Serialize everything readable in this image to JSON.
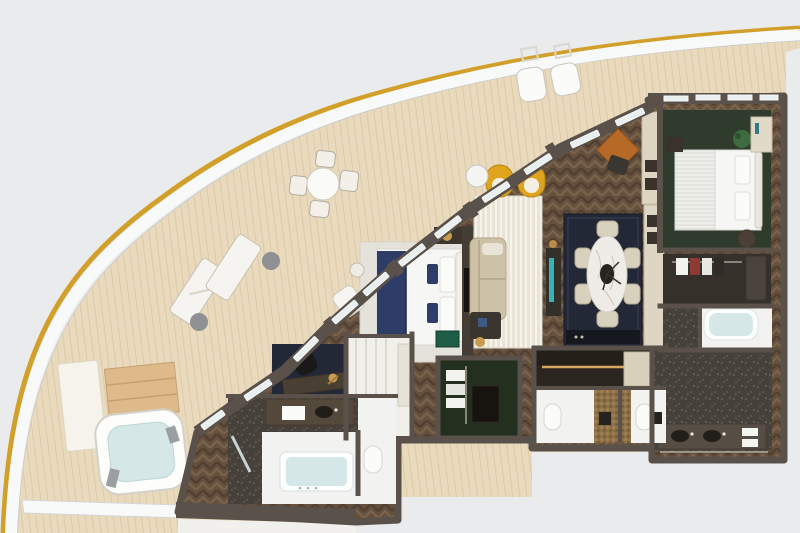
{
  "scene": {
    "type": "floorplan-3d-render",
    "subject": "cruise-ship suite, top-down view",
    "orientation": "curved hull with wrap-around balcony at top-left, interior rooms at right",
    "visible_text": "none"
  },
  "colors": {
    "bg": "#e9ebec",
    "gold": "#d2a02a",
    "hullWhite": "#f8f9f9",
    "hullShadow": "#c7c9ca",
    "deck": "#e9d9bd",
    "deckLine": "#cdb astonish",
    "deckLine2": "#cfb astonish",
    "deckStripe": "#d2bd99",
    "wood": "#65503e",
    "woodLight": "#7d664f",
    "woodDark": "#4c3b2f",
    "wall": "#59514a",
    "wallDark": "#433d36",
    "glass": "#e9eeee",
    "frame": "#f6f8f8",
    "rugLiving": "#e9e4d5",
    "rugStripe": "#f7f4ec",
    "rugBed": "#e5e2db",
    "bedWhite": "#f6f6f4",
    "navy": "#2e3c68",
    "navyDark": "#20294a",
    "yellow": "#dfa41e",
    "sofa": "#cdc1a8",
    "rugDining": "#232836",
    "marble": "#efece7",
    "chairCream": "#d8d1bd",
    "greenBedroom": "#2f3b2d",
    "greenCloset": "#24301f",
    "terrazzo": "#46413a",
    "terrazzoDot": "#6d675e",
    "whiteFloor": "#f2f3f1",
    "goldWall": "#8d7046",
    "water": "#d5e7e6",
    "woodSteps": "#deba8b",
    "cognac": "#b66a28",
    "teal": "#35c2c4",
    "malachite": "#1f5c45",
    "lampGold": "#c89b4e",
    "black": "#1d1b18",
    "pouf": "#4a4036",
    "plant": "#3f6b41",
    "clothesRed": "#8d3a35",
    "counterDark": "#241f19"
  },
  "balcony": {
    "name": "wrap-around teak balcony",
    "items": [
      {
        "name": "outdoor-dining-set",
        "desc": "round white table with four chairs"
      },
      {
        "name": "outdoor-armchairs",
        "desc": "two white cushioned chairs with fold-down wall tables"
      },
      {
        "name": "sun-loungers",
        "desc": "two white loungers with round side tables"
      },
      {
        "name": "jacuzzi",
        "desc": "private whirlpool tub with teak steps and towel mat"
      }
    ]
  },
  "rooms": [
    {
      "name": "master-bedroom",
      "floor": "herringbone wood",
      "furniture": [
        "king bed with navy runner",
        "light rug",
        "TV partition wall",
        "nightstand with lamp",
        "malachite side table",
        "white corner chair"
      ]
    },
    {
      "name": "living-room",
      "floor": "herringbone wood",
      "furniture": [
        "striped cream rug",
        "two yellow arched armchairs",
        "white drum table",
        "beige sofa",
        "dark coffee table",
        "floor lamp",
        "cognac games table with chair",
        "display console with backlit vitrine"
      ]
    },
    {
      "name": "dining-room",
      "floor": "herringbone wood",
      "furniture": [
        "navy area rug",
        "oval marble table",
        "six cream dining chairs",
        "sideboard",
        "cream cabinet pillars with niches"
      ]
    },
    {
      "name": "second-bedroom",
      "floor": "dark green carpet",
      "furniture": [
        "double bed",
        "plant",
        "shelf unit",
        "bedside table",
        "round pouf"
      ]
    },
    {
      "name": "walk-in-closet",
      "floor": "dark wood",
      "furniture": [
        "hanging rail with clothes",
        "shelf tower"
      ]
    },
    {
      "name": "wet-room",
      "floor": "white stone",
      "furniture": [
        "soaking bathtub",
        "shower"
      ]
    },
    {
      "name": "second-bathroom",
      "floor": "dark terrazzo",
      "furniture": [
        "double vanity with two basins",
        "mirror wall",
        "towels"
      ]
    },
    {
      "name": "guest-powder-room-1",
      "floor": "white stone",
      "furniture": [
        "toilet",
        "vessel basin on gold mosaic wall"
      ]
    },
    {
      "name": "guest-powder-room-2",
      "floor": "white stone",
      "furniture": [
        "toilet",
        "vessel basin"
      ]
    },
    {
      "name": "kitchenette-bar",
      "floor": "dark stone",
      "furniture": [
        "bar counter with under-lighting",
        "cream cabinets"
      ]
    },
    {
      "name": "wardrobe-room",
      "floor": "dark green carpet",
      "furniture": [
        "white garment rail",
        "dark dresser"
      ]
    },
    {
      "name": "dressing-area",
      "floor": "white panels",
      "furniture": [
        "wardrobe panels",
        "round stool"
      ]
    },
    {
      "name": "office-nook",
      "floor": "navy inlay",
      "furniture": [
        "writing desk",
        "black chair",
        "brass desk lamp"
      ]
    },
    {
      "name": "master-bathroom",
      "floor": "terrazzo and white stone",
      "furniture": [
        "large soaking tub",
        "vanity with towels",
        "separate WC",
        "glass door to balcony"
      ]
    }
  ]
}
